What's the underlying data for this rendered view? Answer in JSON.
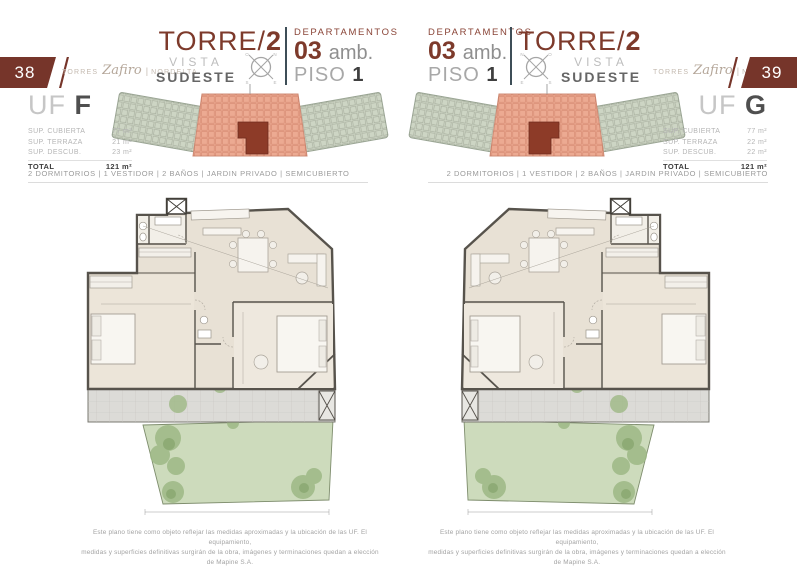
{
  "brand": {
    "torres": "TORRES",
    "zafiro": "Zafiro",
    "sep": "|",
    "nordelta": "NORDELTA"
  },
  "amenities": "2 DORMITORIOS | 1 VESTIDOR | 2 BAÑOS | JARDIN PRIVADO | SEMICUBIERTO",
  "disclaimer": {
    "line1": "Este plano tiene como objeto reflejar las medidas aproximadas y la ubicación de las UF. El equipamiento,",
    "line2": "medidas y superficies definitivas surgirán de la obra, imágenes y terminaciones quedan a elección de Mapine S.A."
  },
  "compass_left": {
    "tl": "O",
    "tr": "N",
    "bl": "S",
    "br": "E"
  },
  "compass_right": {
    "tl": "N",
    "tr": "O",
    "bl": "E",
    "br": "S"
  },
  "page_left": {
    "page_number": "38",
    "tower": {
      "name": "TORRE/",
      "number": "2",
      "vista": "VISTA",
      "direction": "SUDESTE"
    },
    "dept": {
      "label": "DEPARTAMENTOS",
      "number": "03",
      "amb": "amb.",
      "piso_label": "PISO",
      "piso_number": "1"
    },
    "unit": {
      "uf_label": "UF",
      "uf_letter": "F",
      "surfaces": [
        {
          "label": "SUP. CUBIERTA",
          "value": "77 m²"
        },
        {
          "label": "SUP. TERRAZA",
          "value": "21 m²"
        },
        {
          "label": "SUP. DESCUB.",
          "value": "23 m²"
        }
      ],
      "total_label": "TOTAL",
      "total_value": "121 m²"
    }
  },
  "page_right": {
    "page_number": "39",
    "tower": {
      "name": "TORRE/",
      "number": "2",
      "vista": "VISTA",
      "direction": "SUDESTE"
    },
    "dept": {
      "label": "DEPARTAMENTOS",
      "number": "03",
      "amb": "amb.",
      "piso_label": "PISO",
      "piso_number": "1"
    },
    "unit": {
      "uf_label": "UF",
      "uf_letter": "G",
      "surfaces": [
        {
          "label": "SUP. CUBIERTA",
          "value": "77 m²"
        },
        {
          "label": "SUP. TERRAZA",
          "value": "22 m²"
        },
        {
          "label": "SUP. DESCUB.",
          "value": "22 m²"
        }
      ],
      "total_label": "TOTAL",
      "total_value": "121 m²"
    }
  },
  "colors": {
    "maroon": "#76352a",
    "salmon_highlight": "#ecaa92",
    "unit_dark": "#8d3b28",
    "wing_green": "#cdd5c4",
    "plan_beige": "#e8e1d5",
    "wall": "#57534c",
    "garden_green": "#cddbbc",
    "divider_slate": "#3e4e57"
  }
}
